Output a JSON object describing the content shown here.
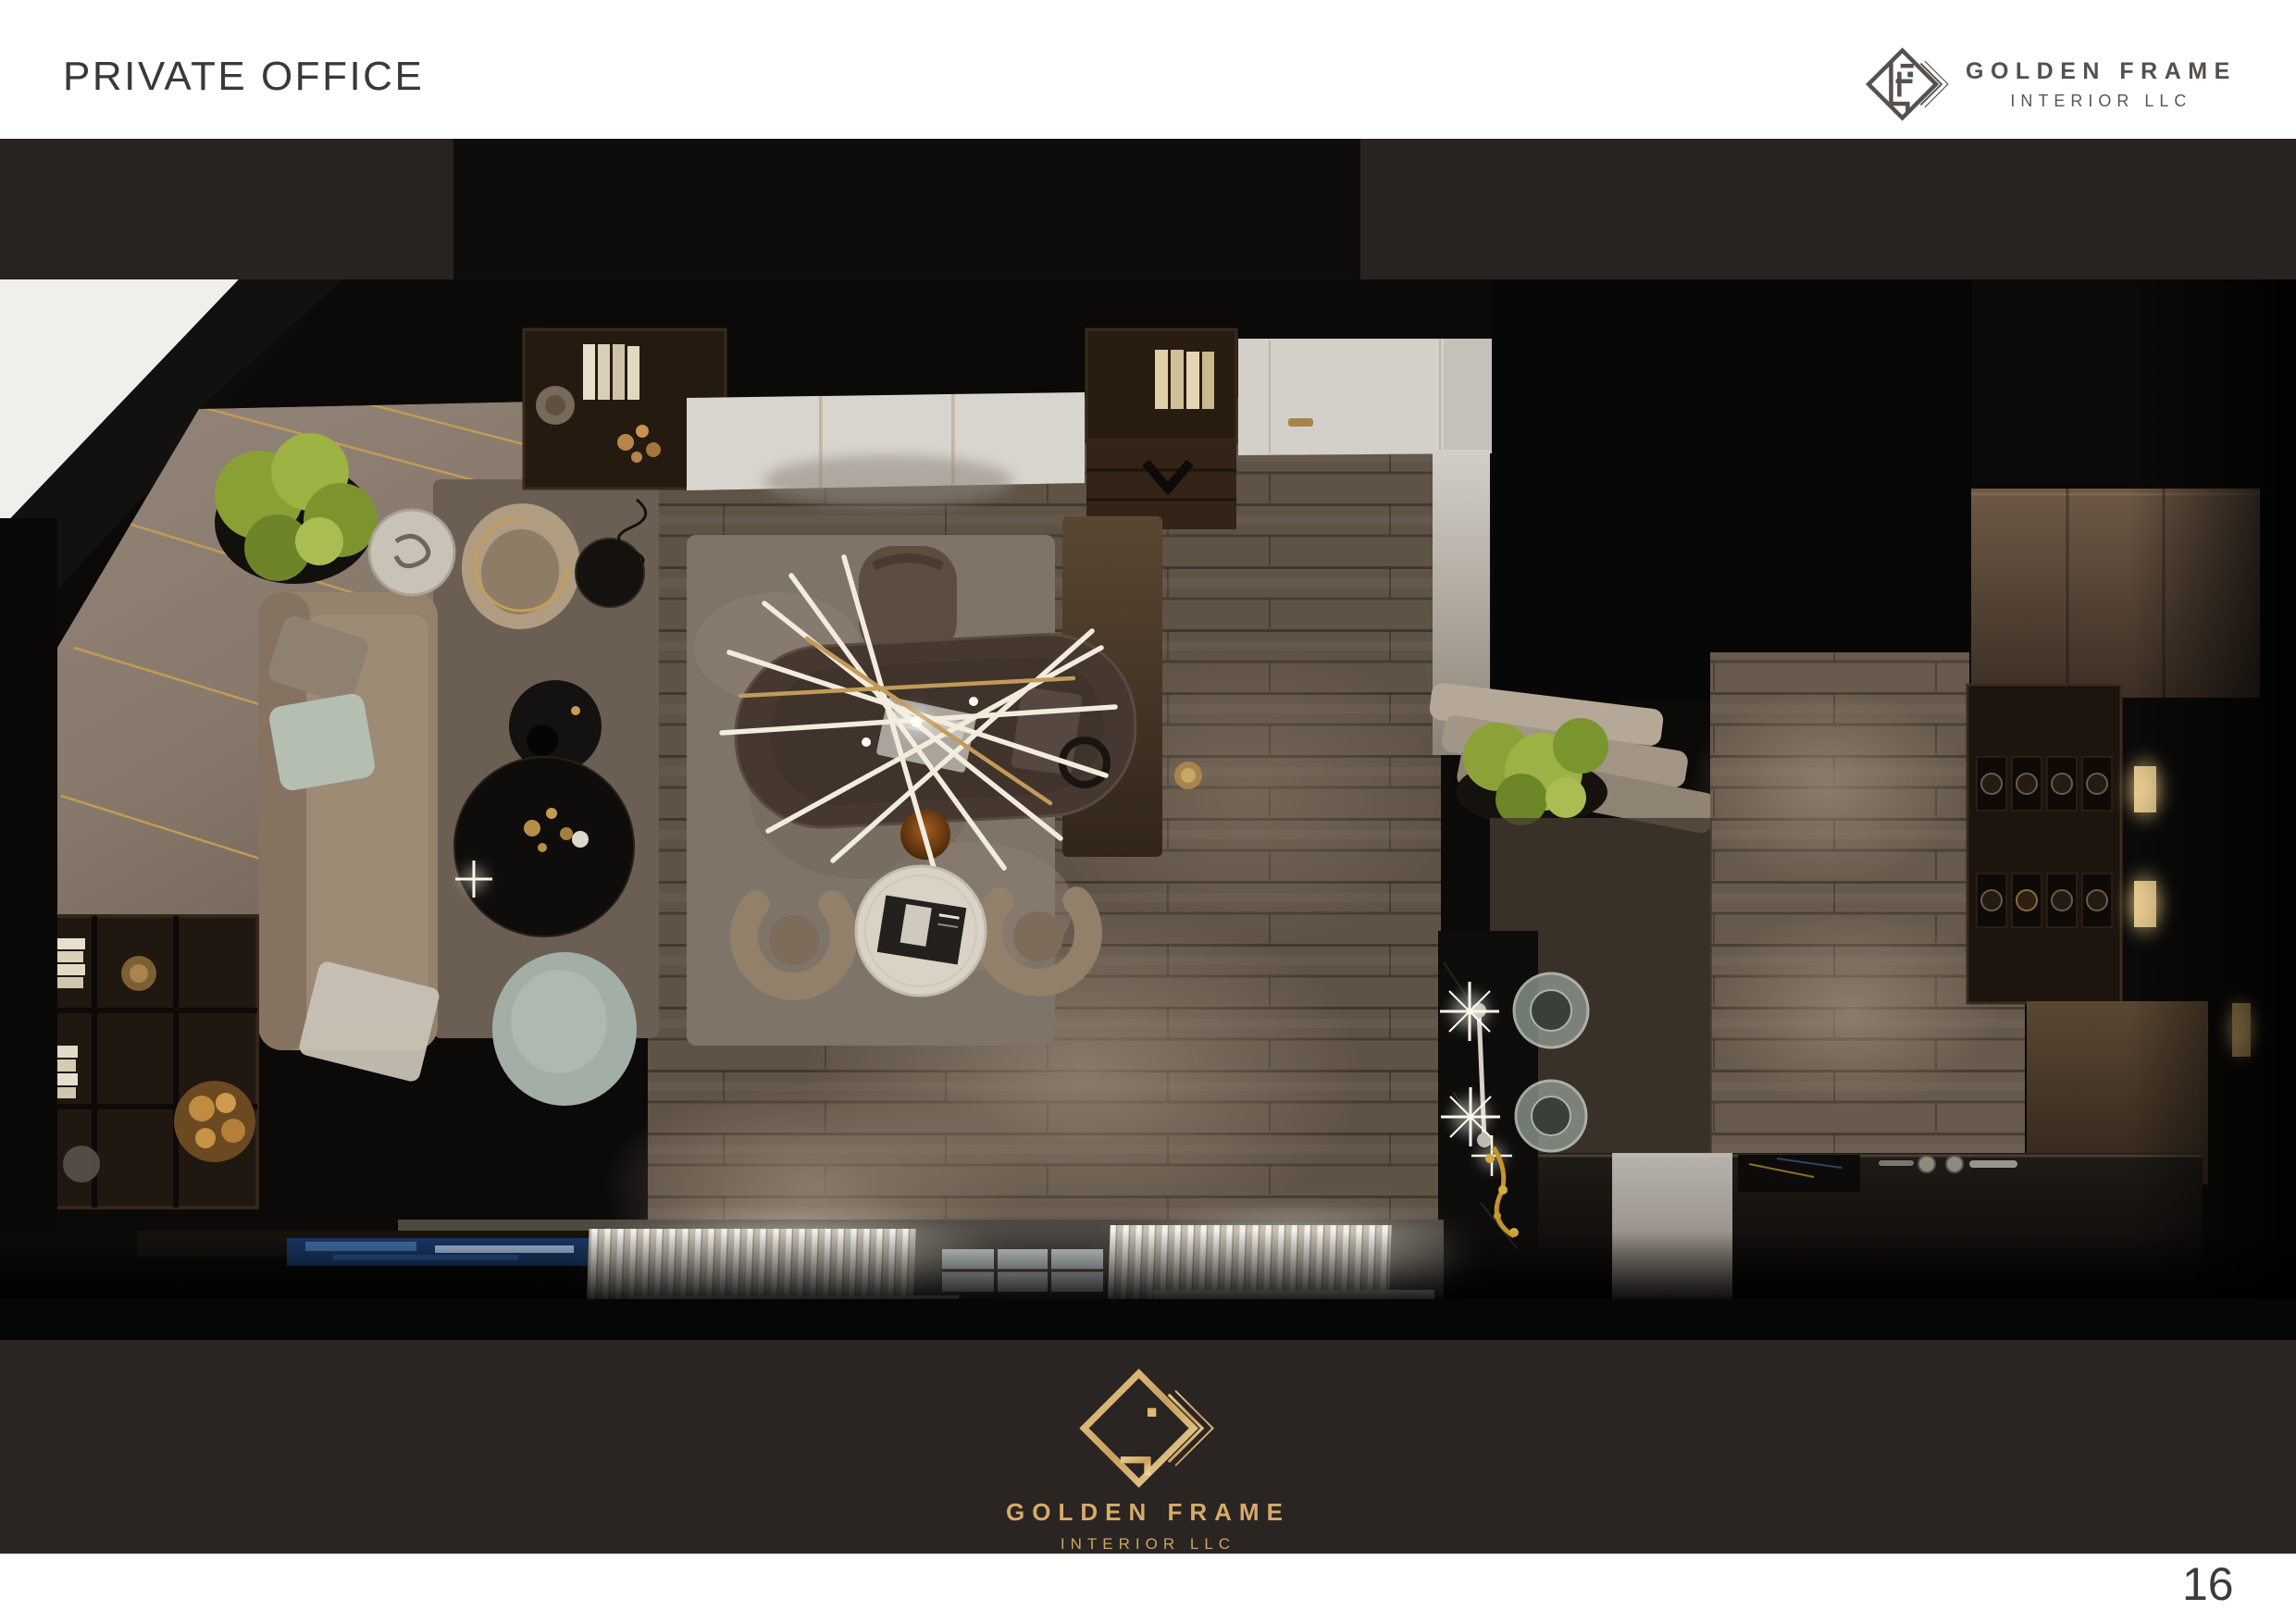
{
  "page": {
    "title": "PRIVATE OFFICE",
    "number": "16"
  },
  "brand": {
    "line1": "GOLDEN FRAME",
    "line2": "INTERIOR LLC",
    "mark": "golden-frame-diamond-monogram-icon",
    "gold": "#d6ab69",
    "gold_deep": "#b98c4a",
    "mark_gray": "#56514d"
  },
  "bands": {
    "top_band": "#282221",
    "bottom_band": "#2a2423",
    "photo_black": "#0b0a09"
  },
  "scene": {
    "alt": "Top-down 3D render of a private office: lounge with beige sofa, round black coffee tables and plants at left; executive desk with sputnik chandelier and guest chairs at center; wood-plank floor; shelving, vanity with glass basins and lit display niches at right; bright curtained windows along the bottom",
    "zones": [
      "lounge",
      "executive-desk-area",
      "wardrobe-wall",
      "hallway",
      "vanity-bathroom",
      "window-wall"
    ]
  }
}
